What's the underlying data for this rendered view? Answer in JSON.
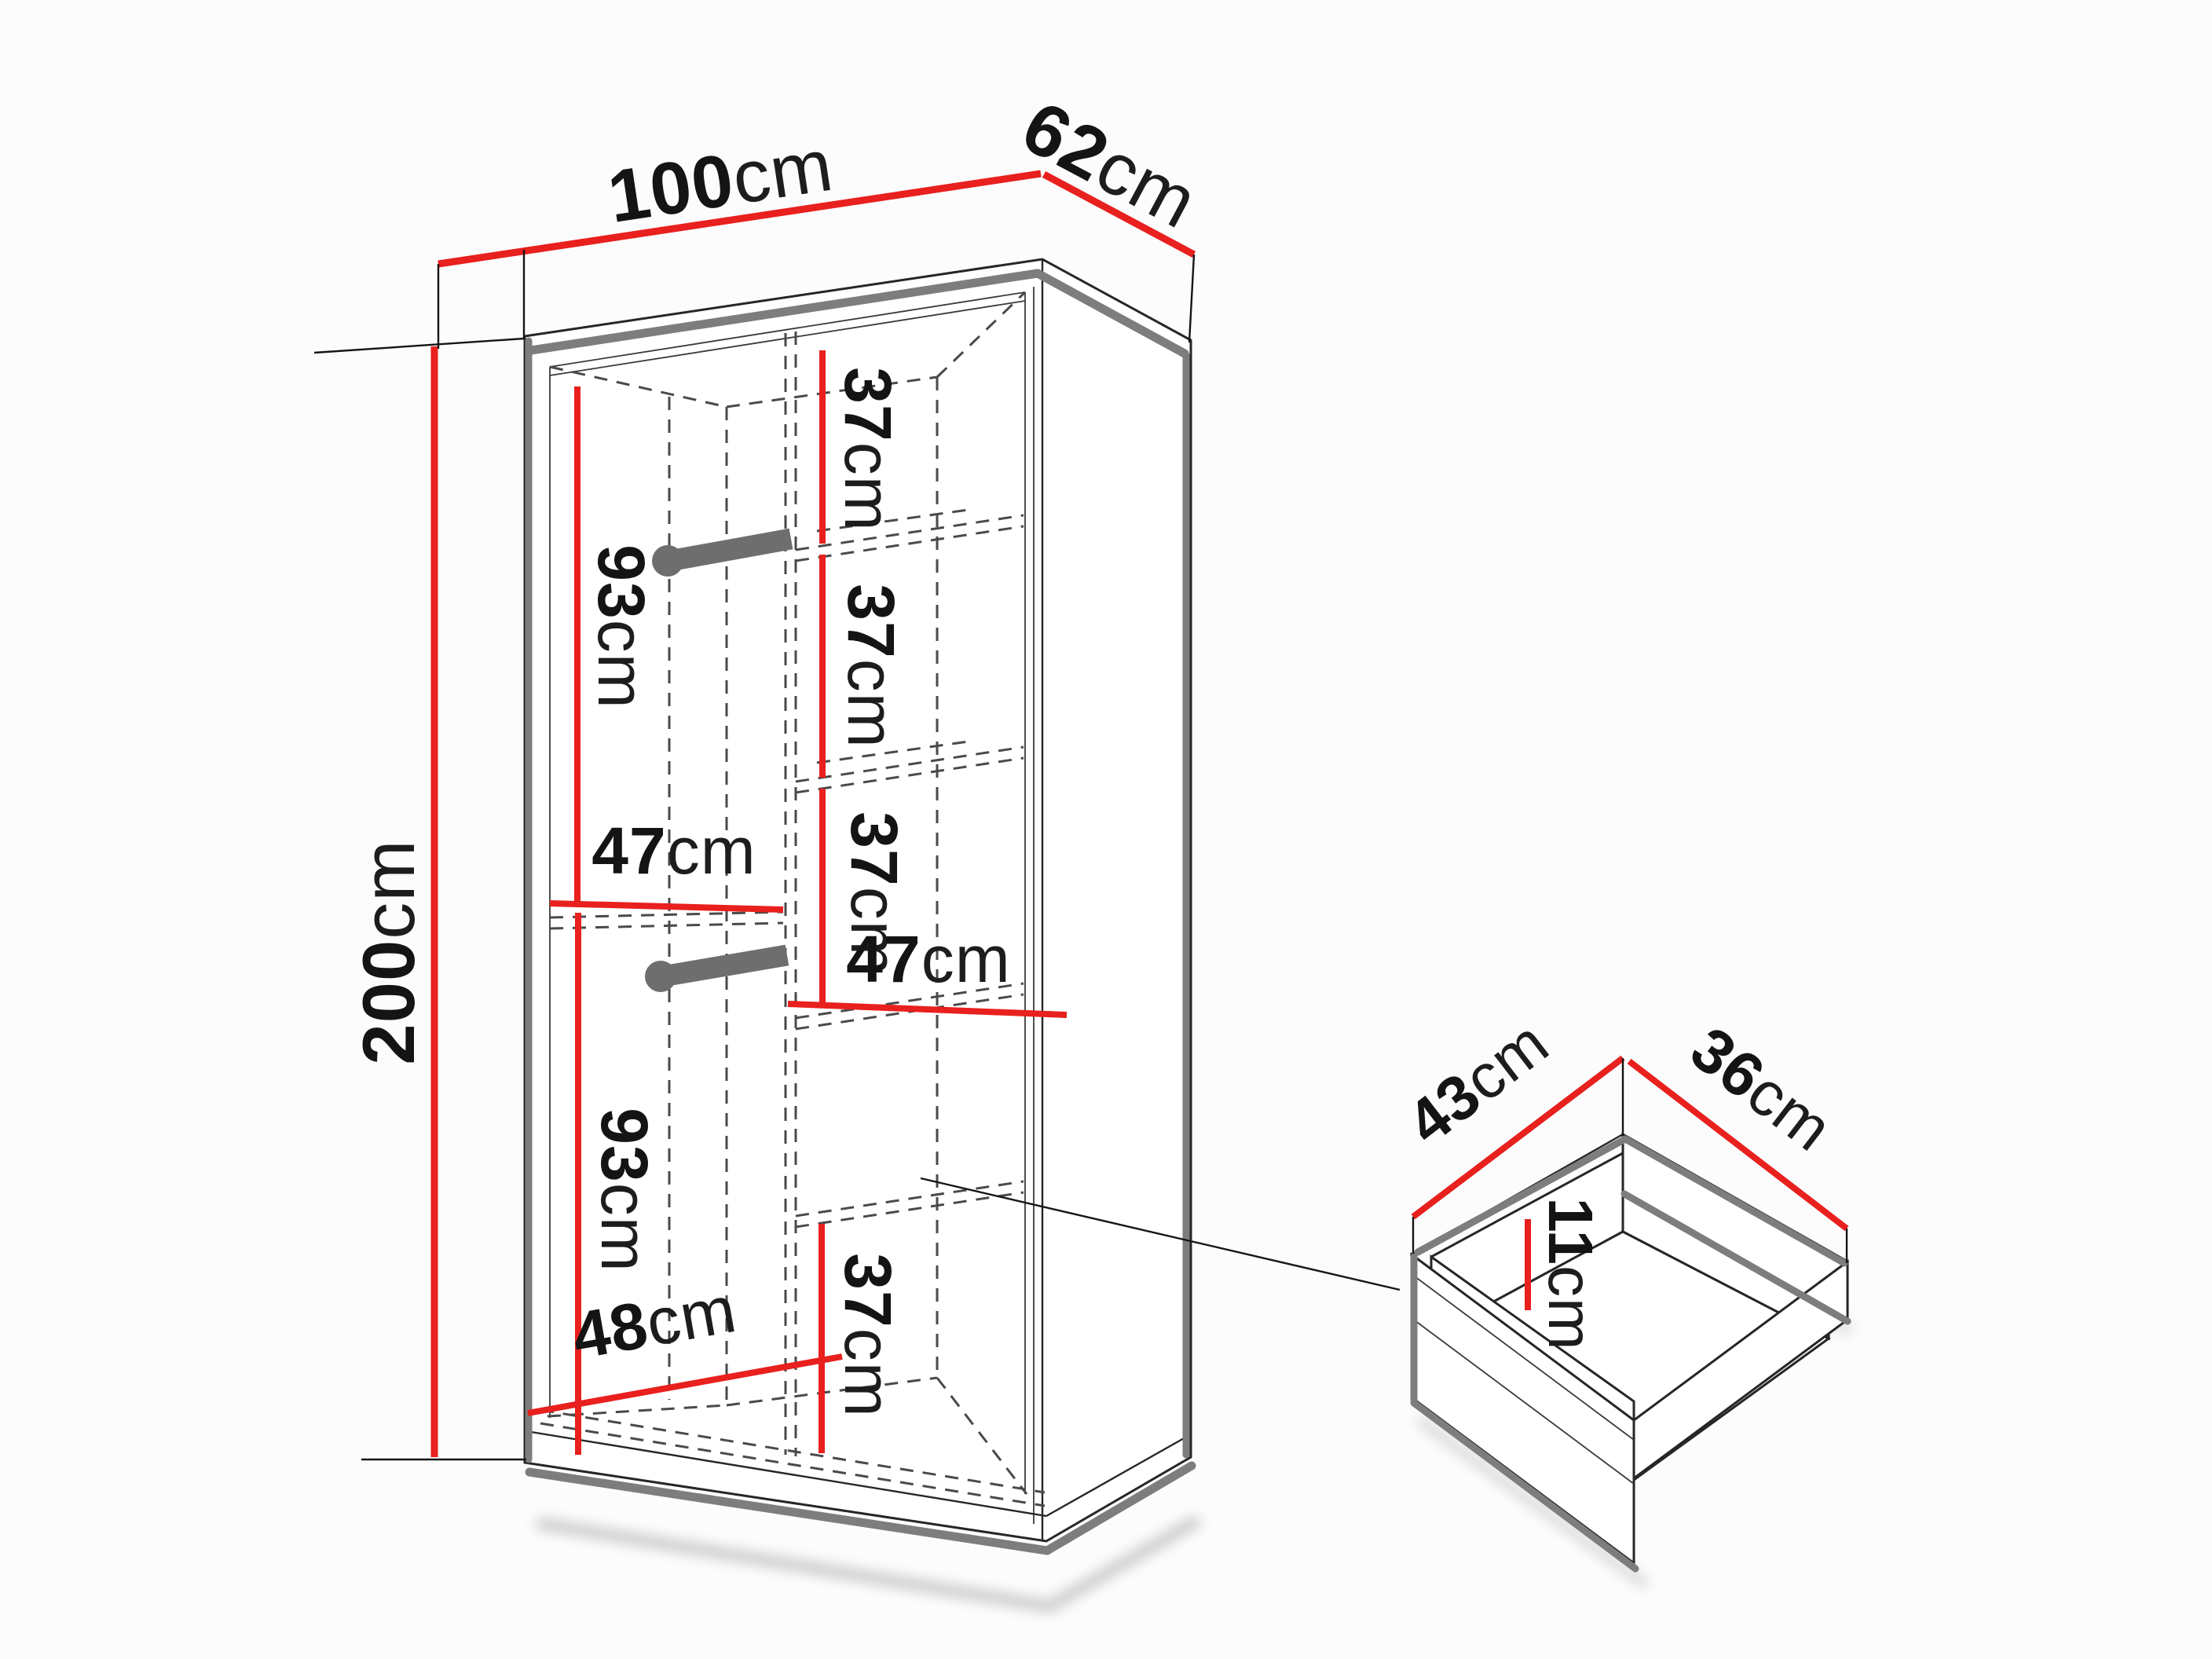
{
  "page": {
    "background": "#fcfcfc"
  },
  "labels": {
    "width": {
      "value": "100",
      "unit": "cm"
    },
    "depth": {
      "value": "62",
      "unit": "cm"
    },
    "height": {
      "value": "200",
      "unit": "cm"
    },
    "hang_top": {
      "value": "93",
      "unit": "cm"
    },
    "mid_shelf_width": {
      "value": "47",
      "unit": "cm"
    },
    "hang_bottom": {
      "value": "93",
      "unit": "cm"
    },
    "bottom_depth": {
      "value": "48",
      "unit": "cm"
    },
    "shelf_gap_1": {
      "value": "37",
      "unit": "cm"
    },
    "shelf_gap_2": {
      "value": "37",
      "unit": "cm"
    },
    "shelf_gap_3": {
      "value": "37",
      "unit": "cm"
    },
    "right_width": {
      "value": "47",
      "unit": "cm"
    },
    "shelf_gap_4": {
      "value": "37",
      "unit": "cm"
    },
    "drawer_depth": {
      "value": "43",
      "unit": "cm"
    },
    "drawer_width": {
      "value": "36",
      "unit": "cm"
    },
    "drawer_height": {
      "value": "11",
      "unit": "cm"
    }
  },
  "colors": {
    "dimension": "#e8201e",
    "edge_shadow": "#7d7d7d",
    "outline": "#262626",
    "hidden_line": "#4a4a4a",
    "background": "#fcfcfc"
  }
}
